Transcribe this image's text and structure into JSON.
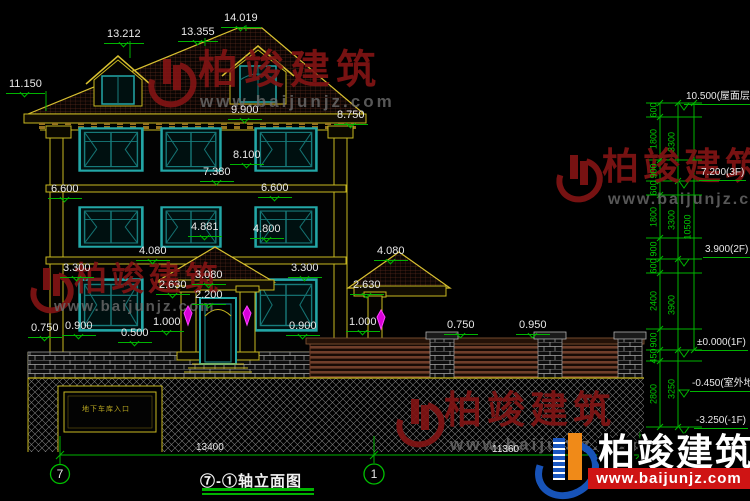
{
  "meta": {
    "background": "#000000",
    "dimension_line_color": "#00b400",
    "dimension_text_color": "#e9e9e9",
    "building_outline_color": "#c8b820",
    "window_frame_color": "#23a7a7",
    "lamp_color": "#ff00ff",
    "watermark_red": "#801414",
    "logo_strip_red": "#cf1414",
    "logo_blue": "#1a57c0",
    "logo_orange": "#f08a18"
  },
  "title": {
    "text": "⑦-①轴立面图"
  },
  "axes": {
    "left": "7",
    "right": "1"
  },
  "garage": {
    "label": "地下车库入口"
  },
  "watermark": {
    "brand": "柏竣建筑",
    "url": "www.baijunjz.com"
  },
  "logo": {
    "brand": "柏竣建筑",
    "url": "www.baijunjz.com"
  },
  "annotations": [
    {
      "t": "14.019",
      "x": 221,
      "y": 13,
      "c": "d"
    },
    {
      "t": "13.355",
      "x": 178,
      "y": 27,
      "c": "d"
    },
    {
      "t": "13.212",
      "x": 104,
      "y": 29,
      "c": "d"
    },
    {
      "t": "11.150",
      "x": 6,
      "y": 79,
      "c": "d"
    },
    {
      "t": "9.900",
      "x": 228,
      "y": 105,
      "c": "d"
    },
    {
      "t": "8.750",
      "x": 334,
      "y": 110,
      "c": "d"
    },
    {
      "t": "8.100",
      "x": 230,
      "y": 150,
      "c": "d"
    },
    {
      "t": "7.380",
      "x": 200,
      "y": 167,
      "c": "d"
    },
    {
      "t": "6.600",
      "x": 48,
      "y": 184,
      "c": "d"
    },
    {
      "t": "6.600",
      "x": 258,
      "y": 183,
      "c": "d"
    },
    {
      "t": "4.881",
      "x": 188,
      "y": 222,
      "c": "d"
    },
    {
      "t": "4.800",
      "x": 250,
      "y": 224,
      "c": "d"
    },
    {
      "t": "4.080",
      "x": 136,
      "y": 246,
      "c": "d"
    },
    {
      "t": "4.080",
      "x": 374,
      "y": 246,
      "c": "d"
    },
    {
      "t": "3.300",
      "x": 60,
      "y": 263,
      "c": "d"
    },
    {
      "t": "3.300",
      "x": 288,
      "y": 263,
      "c": "d"
    },
    {
      "t": "3.080",
      "x": 192,
      "y": 270,
      "c": "d"
    },
    {
      "t": "2.630",
      "x": 156,
      "y": 280,
      "c": "d"
    },
    {
      "t": "2.630",
      "x": 350,
      "y": 280,
      "c": "d"
    },
    {
      "t": "2.200",
      "x": 192,
      "y": 290,
      "c": "d"
    },
    {
      "t": "1.000",
      "x": 150,
      "y": 317,
      "c": "d"
    },
    {
      "t": "1.000",
      "x": 346,
      "y": 317,
      "c": "d"
    },
    {
      "t": "0.900",
      "x": 62,
      "y": 321,
      "c": "d"
    },
    {
      "t": "0.900",
      "x": 286,
      "y": 321,
      "c": "d"
    },
    {
      "t": "0.750",
      "x": 28,
      "y": 323,
      "c": "d"
    },
    {
      "t": "0.750",
      "x": 444,
      "y": 320,
      "c": "d"
    },
    {
      "t": "0.950",
      "x": 516,
      "y": 320,
      "c": "d"
    },
    {
      "t": "0.500",
      "x": 118,
      "y": 328,
      "c": "d"
    },
    {
      "t": "10.500(屋面层)",
      "x": 684,
      "y": 91,
      "c": "L"
    },
    {
      "t": "7.200(3F)",
      "x": 699,
      "y": 167,
      "c": "L"
    },
    {
      "t": "3.900(2F)",
      "x": 703,
      "y": 244,
      "c": "L"
    },
    {
      "t": "±0.000(1F)",
      "x": 695,
      "y": 337,
      "c": "L"
    },
    {
      "t": "-0.450(室外地面)",
      "x": 690,
      "y": 378,
      "c": "L"
    },
    {
      "t": "-3.250(-1F)",
      "x": 694,
      "y": 415,
      "c": "L"
    },
    {
      "t": "600",
      "x": 654,
      "y": 110,
      "c": "r"
    },
    {
      "t": "1800",
      "x": 654,
      "y": 139,
      "c": "r"
    },
    {
      "t": "900",
      "x": 654,
      "y": 171,
      "c": "r"
    },
    {
      "t": "600",
      "x": 654,
      "y": 188,
      "c": "r"
    },
    {
      "t": "1800",
      "x": 654,
      "y": 217,
      "c": "r"
    },
    {
      "t": "900",
      "x": 654,
      "y": 249,
      "c": "r"
    },
    {
      "t": "600",
      "x": 654,
      "y": 266,
      "c": "r"
    },
    {
      "t": "2400",
      "x": 654,
      "y": 301,
      "c": "r"
    },
    {
      "t": "900",
      "x": 654,
      "y": 340,
      "c": "r"
    },
    {
      "t": "450",
      "x": 654,
      "y": 356,
      "c": "r"
    },
    {
      "t": "2800",
      "x": 654,
      "y": 394,
      "c": "r"
    },
    {
      "t": "3300",
      "x": 672,
      "y": 142,
      "c": "r"
    },
    {
      "t": "3300",
      "x": 672,
      "y": 220,
      "c": "r"
    },
    {
      "t": "3900",
      "x": 672,
      "y": 305,
      "c": "r"
    },
    {
      "t": "3250",
      "x": 672,
      "y": 389,
      "c": "r"
    },
    {
      "t": "10500",
      "x": 688,
      "y": 227,
      "c": "r"
    },
    {
      "t": "13400",
      "x": 196,
      "y": 443,
      "c": "p"
    },
    {
      "t": "11360",
      "x": 492,
      "y": 445,
      "c": "p"
    }
  ]
}
